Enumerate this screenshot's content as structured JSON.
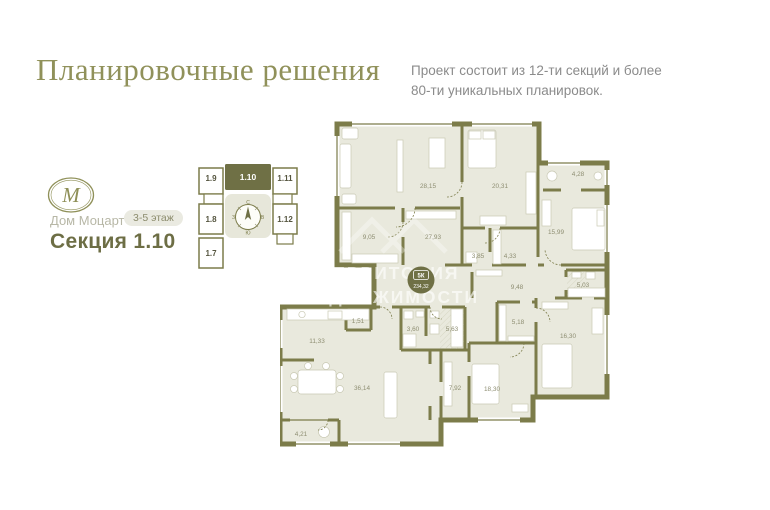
{
  "page": {
    "title": "Планировочные решения",
    "subtitle_line1": "Проект состоит из 12-ти секций и более",
    "subtitle_line2": "80-ти уникальных планировок."
  },
  "brand": {
    "logo_letter": "М",
    "name": "Дом Моцарт",
    "floors_badge": "3-5 этаж",
    "section_title": "Секция 1.10"
  },
  "minimap": {
    "selected": "1.10",
    "cells": [
      {
        "label": "1.9"
      },
      {
        "label": "1.10"
      },
      {
        "label": "1.11"
      },
      {
        "label": "1.8"
      },
      {
        "label": "1.12"
      },
      {
        "label": "1.7"
      }
    ],
    "compass": {
      "north": "С",
      "east": "В",
      "south": "Ю",
      "west": "З"
    }
  },
  "floorplan": {
    "unit_badge": {
      "type": "5К",
      "area": "234,32"
    },
    "watermark": {
      "line1": "ТЕРРИТОРИЯ",
      "line2": "НЕДВИЖИМОСТИ"
    },
    "rooms": [
      {
        "area": "28,15"
      },
      {
        "area": "20,31"
      },
      {
        "area": "4,28"
      },
      {
        "area": "15,99"
      },
      {
        "area": "9,05"
      },
      {
        "area": "27,93"
      },
      {
        "area": "3,85"
      },
      {
        "area": "4,33"
      },
      {
        "area": "9,48"
      },
      {
        "area": "5,03"
      },
      {
        "area": "5,18"
      },
      {
        "area": "16,30"
      },
      {
        "area": "1,51"
      },
      {
        "area": "3,60"
      },
      {
        "area": "5,63"
      },
      {
        "area": "11,33"
      },
      {
        "area": "36,14"
      },
      {
        "area": "7,92"
      },
      {
        "area": "18,30"
      },
      {
        "area": "4,21"
      }
    ]
  },
  "colors": {
    "accent": "#7c7c4a",
    "accent_dark": "#6f7045",
    "room_fill": "#e9e9dd",
    "title_olive": "#90915a",
    "text_gray": "#8b8b8b"
  }
}
